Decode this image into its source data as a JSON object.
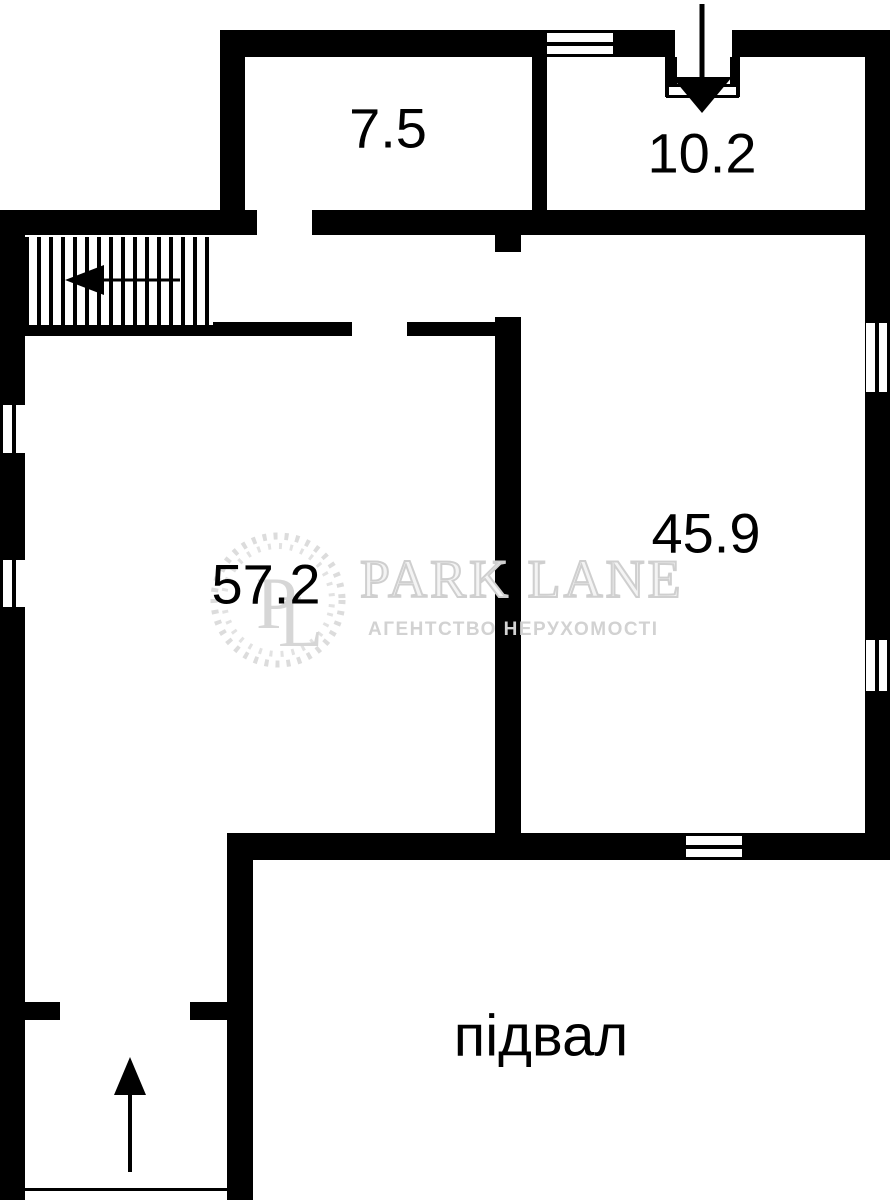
{
  "floorplan": {
    "room_labels": {
      "top_left_room": "7.5",
      "top_right_room": "10.2",
      "left_room": "57.2",
      "right_room": "45.9",
      "basement": "підвал"
    },
    "colors": {
      "wall": "#000000",
      "background": "#ffffff",
      "watermark": "#d9d9d9"
    }
  },
  "watermark": {
    "brand": "PARK LANE",
    "tagline": "АГЕНТСТВО НЕРУХОМОСТІ",
    "monogram": [
      "P",
      "L"
    ]
  }
}
